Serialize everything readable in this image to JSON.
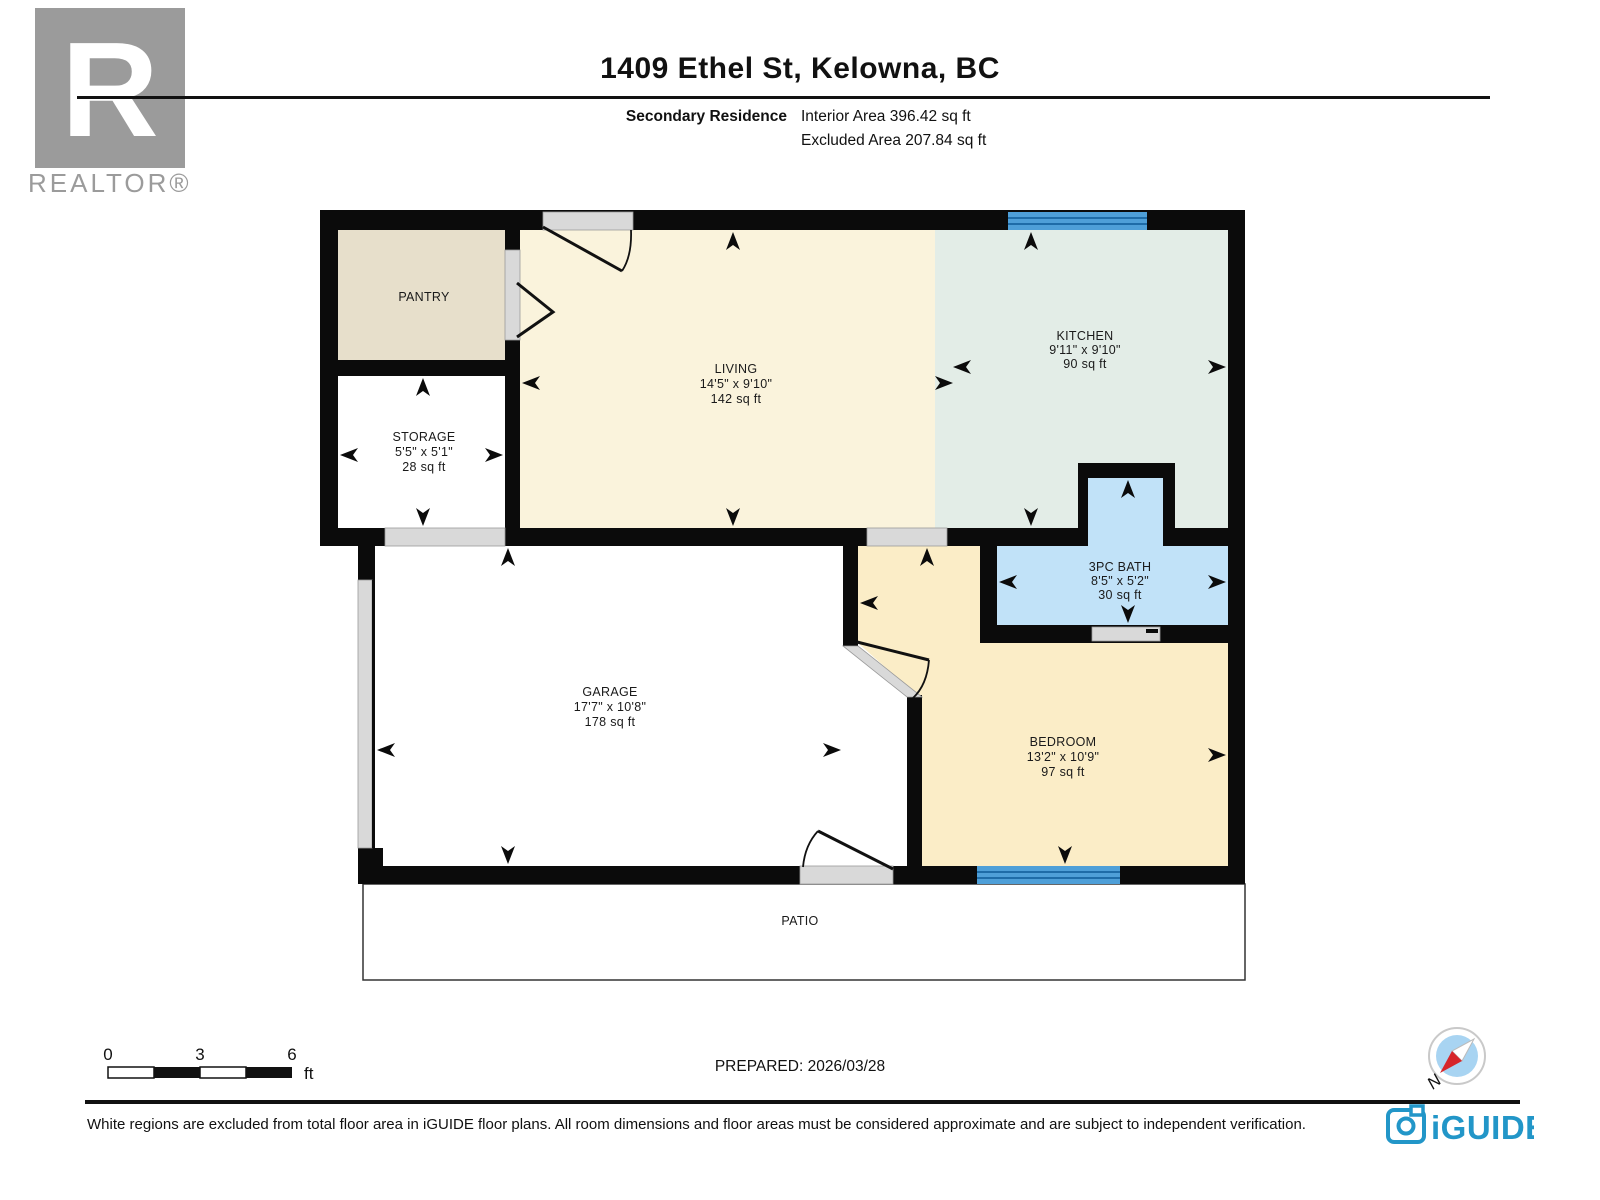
{
  "header": {
    "title": "1409 Ethel St, Kelowna, BC",
    "plan_label": "Secondary Residence",
    "interior_area": "Interior Area 396.42 sq ft",
    "excluded_area": "Excluded Area 207.84 sq ft",
    "realtor_logo_letter": "R",
    "realtor_logo_text": "REALTOR®"
  },
  "floorplan": {
    "rooms": [
      {
        "name": "PANTRY",
        "dims": "",
        "area": ""
      },
      {
        "name": "STORAGE",
        "dims": "5'5\" x 5'1\"",
        "area": "28 sq ft"
      },
      {
        "name": "LIVING",
        "dims": "14'5\" x 9'10\"",
        "area": "142 sq ft"
      },
      {
        "name": "KITCHEN",
        "dims": "9'11\" x 9'10\"",
        "area": "90 sq ft"
      },
      {
        "name": "3PC BATH",
        "dims": "8'5\" x 5'2\"",
        "area": "30 sq ft"
      },
      {
        "name": "GARAGE",
        "dims": "17'7\" x 10'8\"",
        "area": "178 sq ft"
      },
      {
        "name": "BEDROOM",
        "dims": "13'2\" x 10'9\"",
        "area": "97 sq ft"
      },
      {
        "name": "PATIO",
        "dims": "",
        "area": ""
      }
    ],
    "colors": {
      "living": "#FAF3DC",
      "pantry": "#E7DFCB",
      "kitchen": "#E3EDE7",
      "bath": "#C1E2F8",
      "bedroom": "#FBEDC7",
      "garage": "#FFFFFF",
      "wall": "#0B0B0B",
      "window_blue": "#4E9FD8",
      "window_stripe": "#1E6CA8",
      "opening_gray": "#D9D9D9",
      "compass_red": "#D6252A",
      "compass_blue": "#A8D4F2",
      "brand_blue": "#2296C8",
      "realtor_gray": "#9B9B9B"
    }
  },
  "footer": {
    "scale": {
      "tick0": "0",
      "tick3": "3",
      "tick6": "6",
      "unit": "ft"
    },
    "prepared": "PREPARED: 2026/03/28",
    "compass_label": "N",
    "disclaimer": "White regions are excluded from total floor area in iGUIDE floor plans. All room dimensions and floor areas must be considered approximate and are subject to independent verification.",
    "brand": "iGUIDE"
  }
}
